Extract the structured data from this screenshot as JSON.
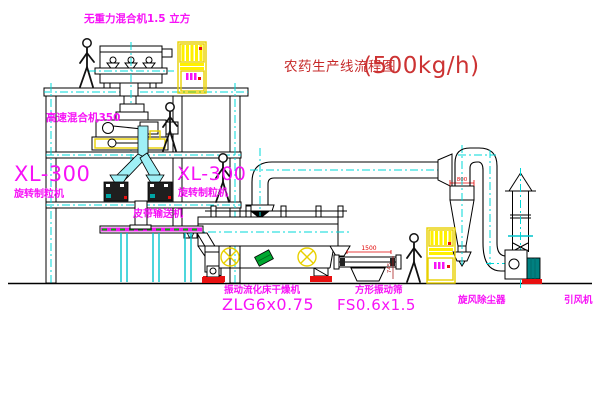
{
  "title": {
    "text": "农药生产线流程图",
    "capacity": "(500kg/h)"
  },
  "labels": {
    "gravity_mixer": "无重力混合机1.5 立方",
    "high_speed_mixer": "高速混合机350",
    "granulator_left": {
      "model": "XL-300",
      "name": "旋转制粒机"
    },
    "granulator_right": {
      "model": "XL-300",
      "name": "旋转制粒机"
    },
    "belt_conveyor": "皮带输送机",
    "dryer": {
      "name": "振动流化床干燥机",
      "model": "ZLG6x0.75"
    },
    "sieve": {
      "name": "方形振动筛",
      "model": "FS0.6x1.5"
    },
    "cyclone": "旋风除尘器",
    "fan": "引风机"
  },
  "dimensions": {
    "sieve_width": "1500",
    "sieve_height": "745",
    "cyclone_inlet": "800"
  },
  "colors": {
    "label_magenta": "#F712F7",
    "title_red": "#C62828",
    "capacity_red": "#CC3333",
    "dimension_red": "#E00000",
    "dim_dark_red": "#AA2222",
    "line_black": "#000000",
    "centerline_cyan": "#00D8D8",
    "chute_cyan": "#9FF0F6",
    "cabinet_yellow": "#FFF000",
    "accent_green": "#00A830",
    "fan_teal": "#008080",
    "base_red": "#E81010"
  }
}
